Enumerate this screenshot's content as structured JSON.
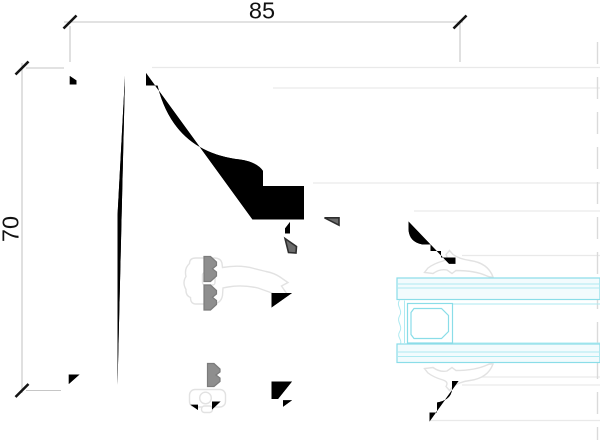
{
  "drawing": {
    "title": "window-frame-profile-cross-section",
    "dimensions": {
      "width": {
        "label": "85",
        "value": 85
      },
      "height": {
        "label": "70",
        "value": 70
      }
    },
    "parts": {
      "frame": "outer-frame-profile",
      "sash": "sash-profile",
      "glazing": "insulated-glass-unit",
      "spacer": "glazing-spacer-bar",
      "gaskets": [
        "frame-sash-gasket",
        "glazing-gasket-top",
        "glazing-gasket-bottom",
        "bottom-seal-gasket"
      ]
    },
    "colors": {
      "bg": "#ffffff",
      "faint": "#e9e9e9",
      "dim_line": "#c6c6c6",
      "tick": "#141414",
      "text": "#111111",
      "frame": "#8e8e8e",
      "frame_edge": "#7b7b7b",
      "sash": "#6c6c6c",
      "sash_outline": "#2e2e2e",
      "gasket": "#e2e2e2",
      "glass_line": "#8adde8",
      "glass_inner": "#aeeaf1",
      "glass_fill": "#f2fbfd",
      "break_line": "#dadada"
    }
  }
}
